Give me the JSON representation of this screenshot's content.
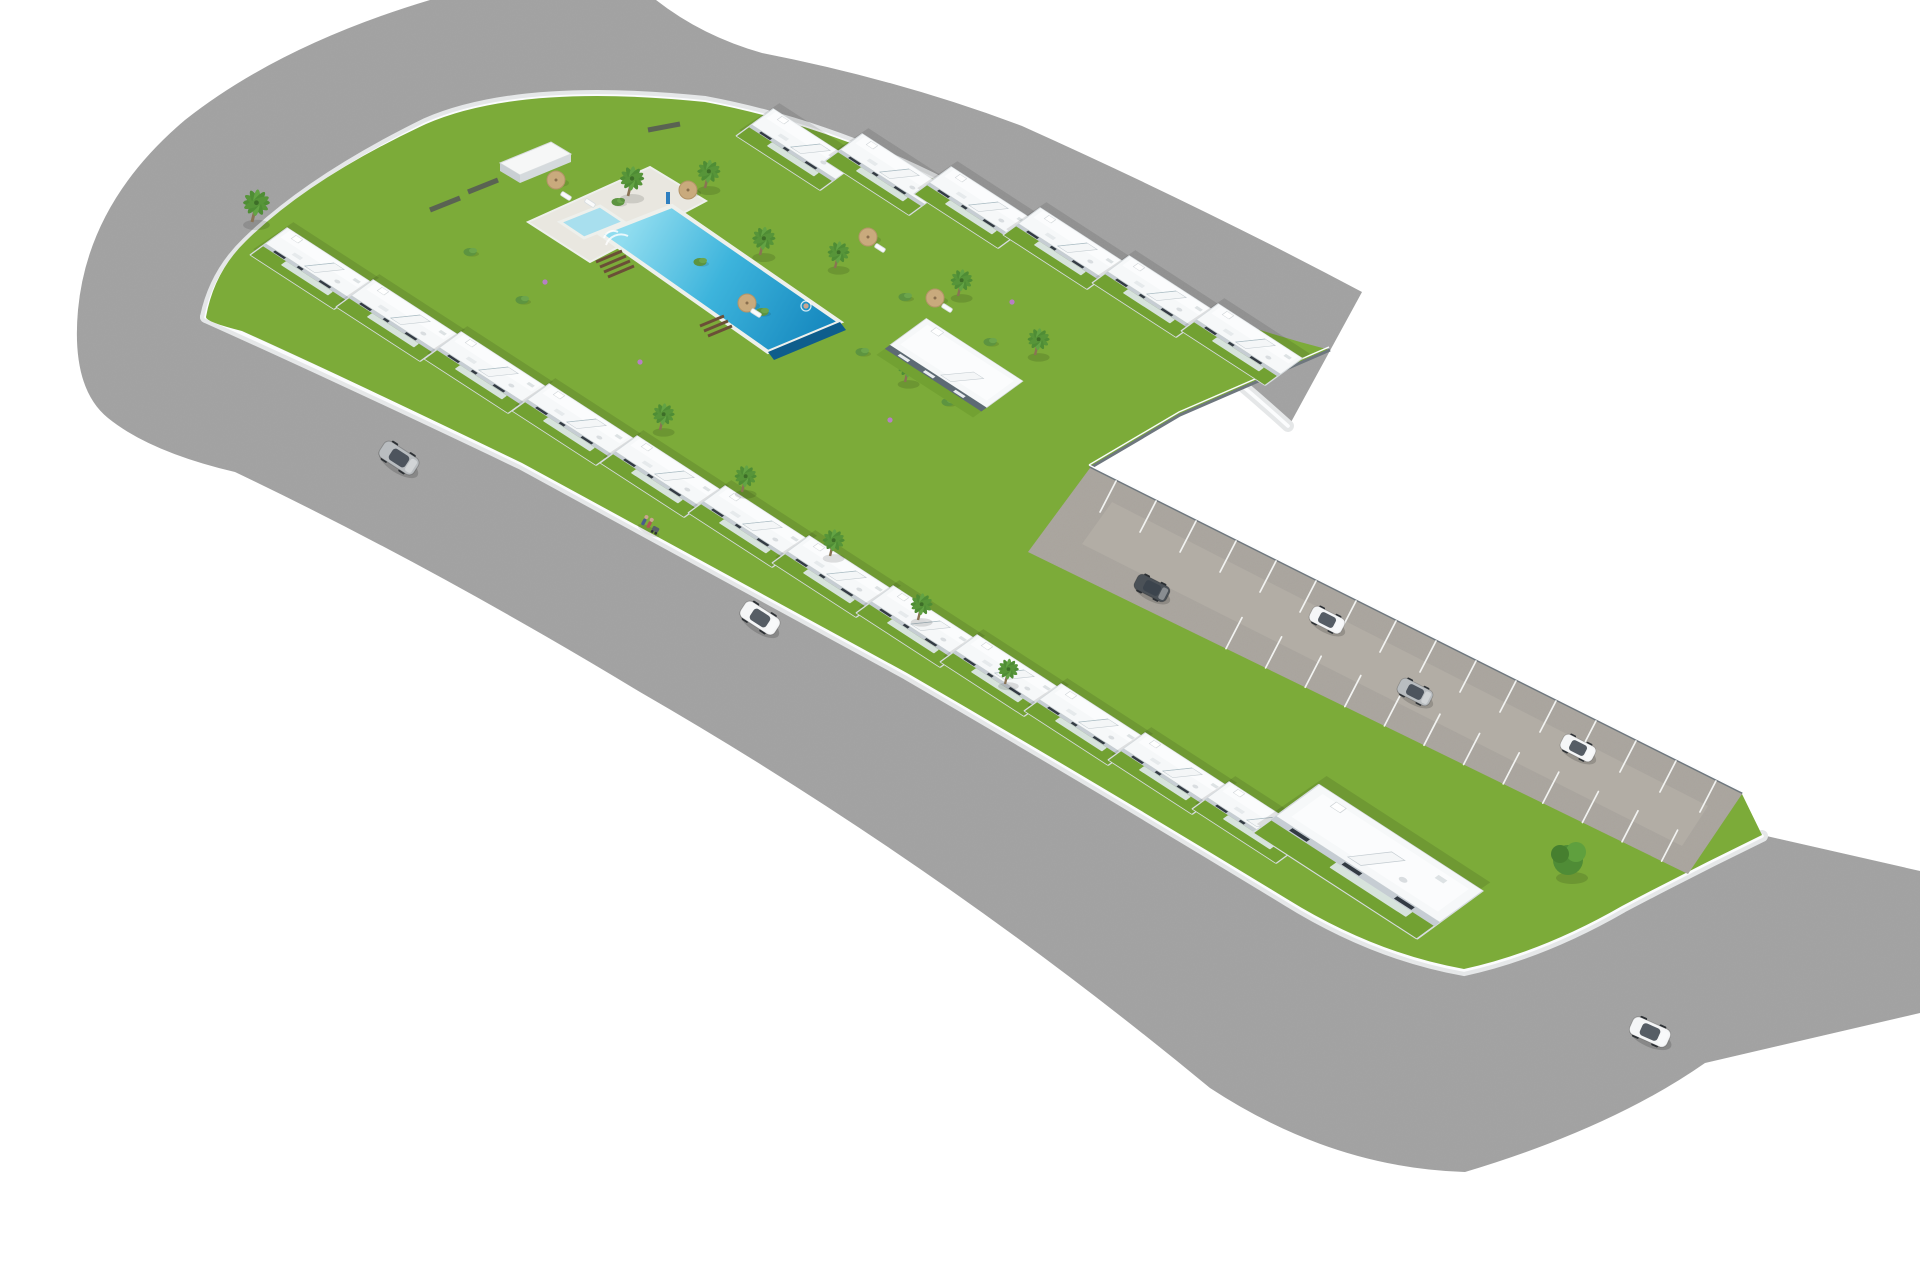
{
  "meta": {
    "title": "Aerial 3D architectural render of an L-shaped white residential development with communal pool",
    "type": "architectural-visualization",
    "background": "plain white"
  },
  "palette": {
    "bg": "#ffffff",
    "road": "#a1a1a1",
    "sidewalk": "#e5e7e8",
    "curb": "#fbfcfd",
    "grass": "#7cab39",
    "grassdark": "#72a132",
    "pavement": "#a9a49d",
    "lane": "#b2ada5",
    "bayline": "#f2f3f1",
    "deck": "#e9e7e0",
    "coping": "#eef0ec",
    "pool_light": "#8fdcef",
    "pool_mid": "#3db4dc",
    "pool_deep": "#1486bd",
    "pool_edge": "#0e5d8c",
    "kiddie": "#a8dfee",
    "roof": "#f6f8f9",
    "roof2": "#fbfcfd",
    "shade": "#c6cdd3",
    "window": "#333b43",
    "glass": "#dfe8ea",
    "stair": "#f4f6f7",
    "walllite": "#d7dcdf",
    "walldark": "#6e777e",
    "accent": "#5d6a74",
    "palm": "#4f8d35",
    "palm2": "#63a344",
    "trunk": "#8a7354",
    "bush": "#5d9440",
    "tree": "#4f8c36",
    "umbrella": "#c9aa7d",
    "steps": "#6b4f37",
    "car_white": "#f5f6f7",
    "car_silver": "#b9bdc0",
    "car_dark": "#4b5157",
    "skin": "#caa58f"
  },
  "scene": {
    "development": {
      "rows": [
        {
          "id": "row-a",
          "label": "townhouse row along north-west street",
          "units": 5
        },
        {
          "id": "row-b",
          "label": "townhouse row along south-west street",
          "units": 7
        },
        {
          "id": "row-c",
          "label": "townhouse row facing the communal garden",
          "units": 6
        }
      ],
      "corner_house": {
        "label": "two-tone corner apartment building",
        "accent": "dark blue-grey"
      },
      "end_house": {
        "label": "large apartment block at south-east end of the row"
      },
      "utility_building": {
        "label": "small white pool-side storage building"
      }
    },
    "amenities": {
      "main_pool": {
        "shape": "long rectangle",
        "water": "turquoise",
        "features": [
          "roman steps",
          "infinity edge"
        ]
      },
      "kiddie_pool": {
        "shape": "small rectangle"
      },
      "wooden_step_flights": 2,
      "umbrellas": 5,
      "sun_loungers": 5
    },
    "landscape": {
      "palms": 13,
      "leafy_trees": 1,
      "bushes": 9,
      "flower_accents": 4
    },
    "parking": {
      "bays_upper": 16,
      "bays_lower": 12
    },
    "vehicles": {
      "cars": [
        {
          "color": "silver",
          "location": "north-west street"
        },
        {
          "color": "white",
          "location": "south-west street"
        },
        {
          "color": "dark",
          "location": "parking lane start"
        },
        {
          "color": "white",
          "location": "parking lane"
        },
        {
          "color": "silver",
          "location": "parking lane"
        },
        {
          "color": "white",
          "location": "parking bay near end"
        },
        {
          "color": "white",
          "location": "south-east street"
        }
      ]
    },
    "people": {
      "pedestrians": 2,
      "stroller": 1,
      "swimmer": 1
    }
  }
}
